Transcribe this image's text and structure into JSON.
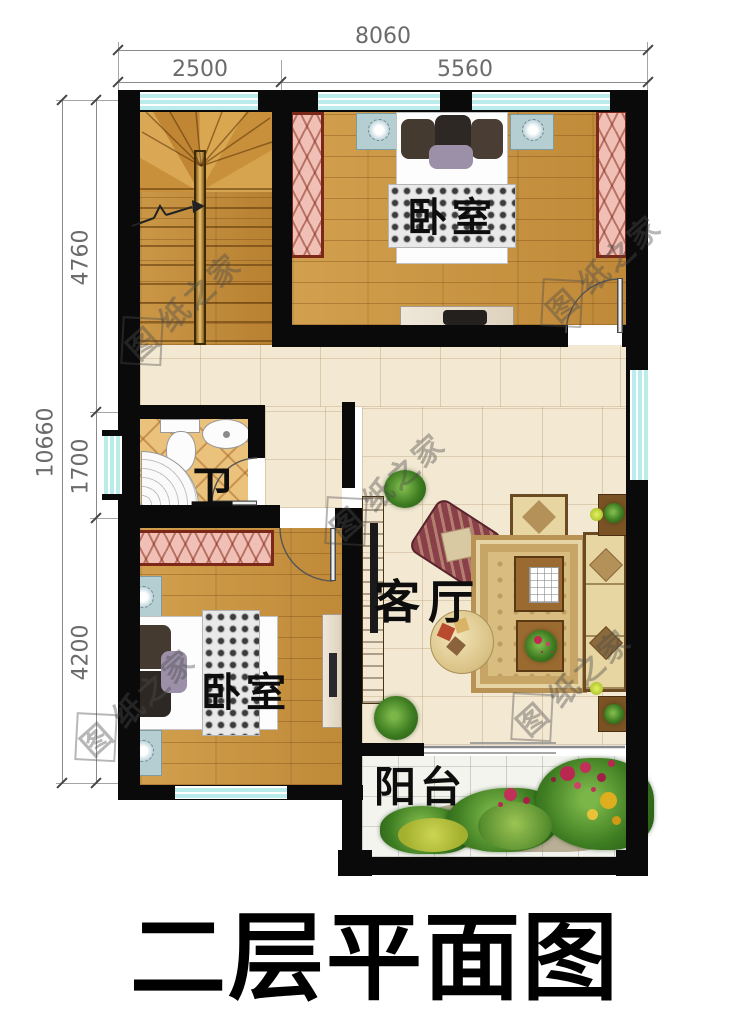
{
  "title": "二层平面图",
  "watermark": {
    "first": "图",
    "rest": "纸之家"
  },
  "dimensions": {
    "top": {
      "overall": "8060",
      "seg1": "2500",
      "seg2": "5560"
    },
    "left": {
      "overall": "10660",
      "seg1": "4760",
      "seg2": "1700",
      "seg3": "4200"
    }
  },
  "rooms": {
    "bedroom_top": "卧室",
    "bedroom_bottom": "卧室",
    "bathroom": "卫",
    "living_room": "客厅",
    "balcony": "阳台"
  },
  "colors": {
    "wall": "#0a0a0a",
    "window": "#b9ecea",
    "wood_floor": "#c99440",
    "tile_floor": "#f3e8d2",
    "bath_tile": "#ebc27c",
    "balcony_tile": "#f4f4ef",
    "wardrobe_fill": "#f0c0b6",
    "wardrobe_frame": "#7c2818",
    "dimension_text": "#6b6b6b"
  }
}
